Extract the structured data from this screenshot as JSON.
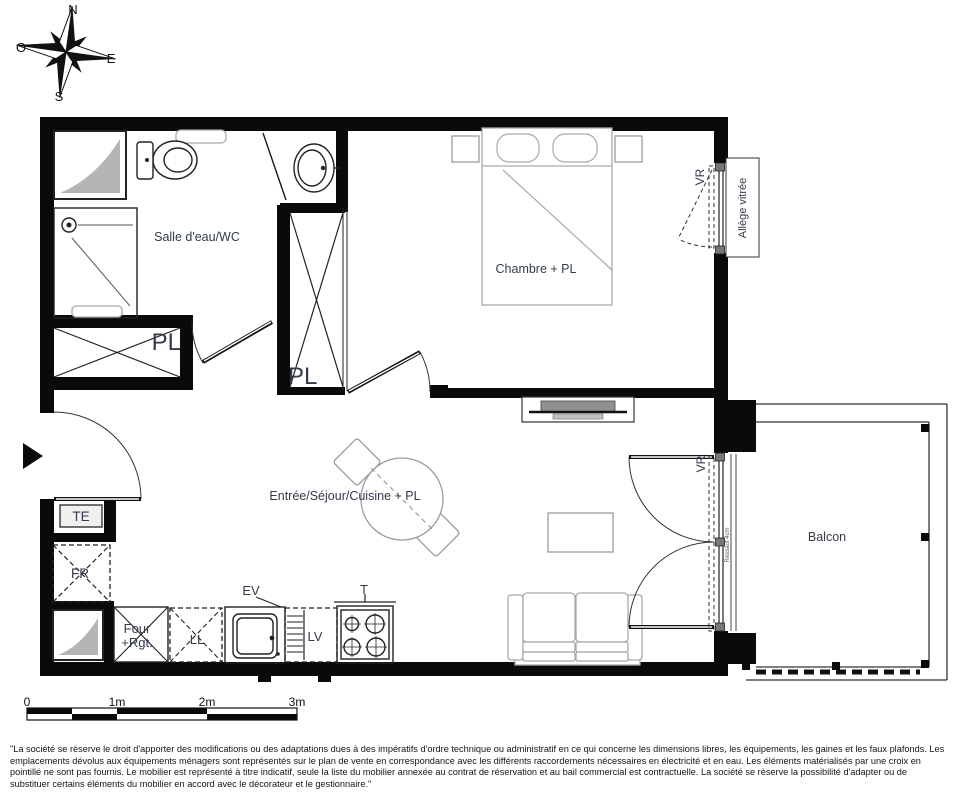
{
  "compass": {
    "north": "N",
    "west": "O",
    "east": "E",
    "south": "S"
  },
  "rooms": {
    "bathroom": "Salle d'eau/WC",
    "bedroom": "Chambre + PL",
    "living": "Entrée/Séjour/Cuisine + PL",
    "balcony": "Balcon"
  },
  "fixtures": {
    "closet_hall": "PL",
    "closet_bedroom": "PL",
    "electrical_panel": "TE",
    "fridge": "FR",
    "oven_line1": "Four",
    "oven_line2": "+Rgt.",
    "washer": "LL",
    "sink": "EV",
    "dishwasher": "LV",
    "hob": "T"
  },
  "windows": {
    "roller_bedroom": "VR",
    "roller_living": "VR",
    "glazed_sill": "Allège vitrée",
    "step": "Ressaut 4cm"
  },
  "scale_bar": {
    "ticks": [
      "0",
      "1m",
      "2m",
      "3m"
    ]
  },
  "colors": {
    "walls": "#0a0a0a",
    "labels": "#333b49",
    "furniture": "#a9a9a9",
    "shaft_fill": "#b5b5b5"
  },
  "disclaimer": "\"La société se réserve le droit d'apporter des modifications ou des adaptations dues à des impératifs d'ordre technique ou administratif en ce qui concerne les dimensions libres, les équipements, les gaines et les faux plafonds. Les emplacements dévolus aux équipements ménagers sont représentés sur le plan de vente en correspondance avec les différents raccordements nécessaires en électricité et en eau. Les éléments matérialisés par une croix en pointillé ne sont pas fournis. Le mobilier est représenté à titre indicatif, seule la liste du mobilier annexée au contrat de réservation et au bail commercial est contractuelle. La société se réserve la possibilité d'adapter ou de substituer certains éléments du mobilier en accord avec le décorateur et le gestionnaire.\""
}
